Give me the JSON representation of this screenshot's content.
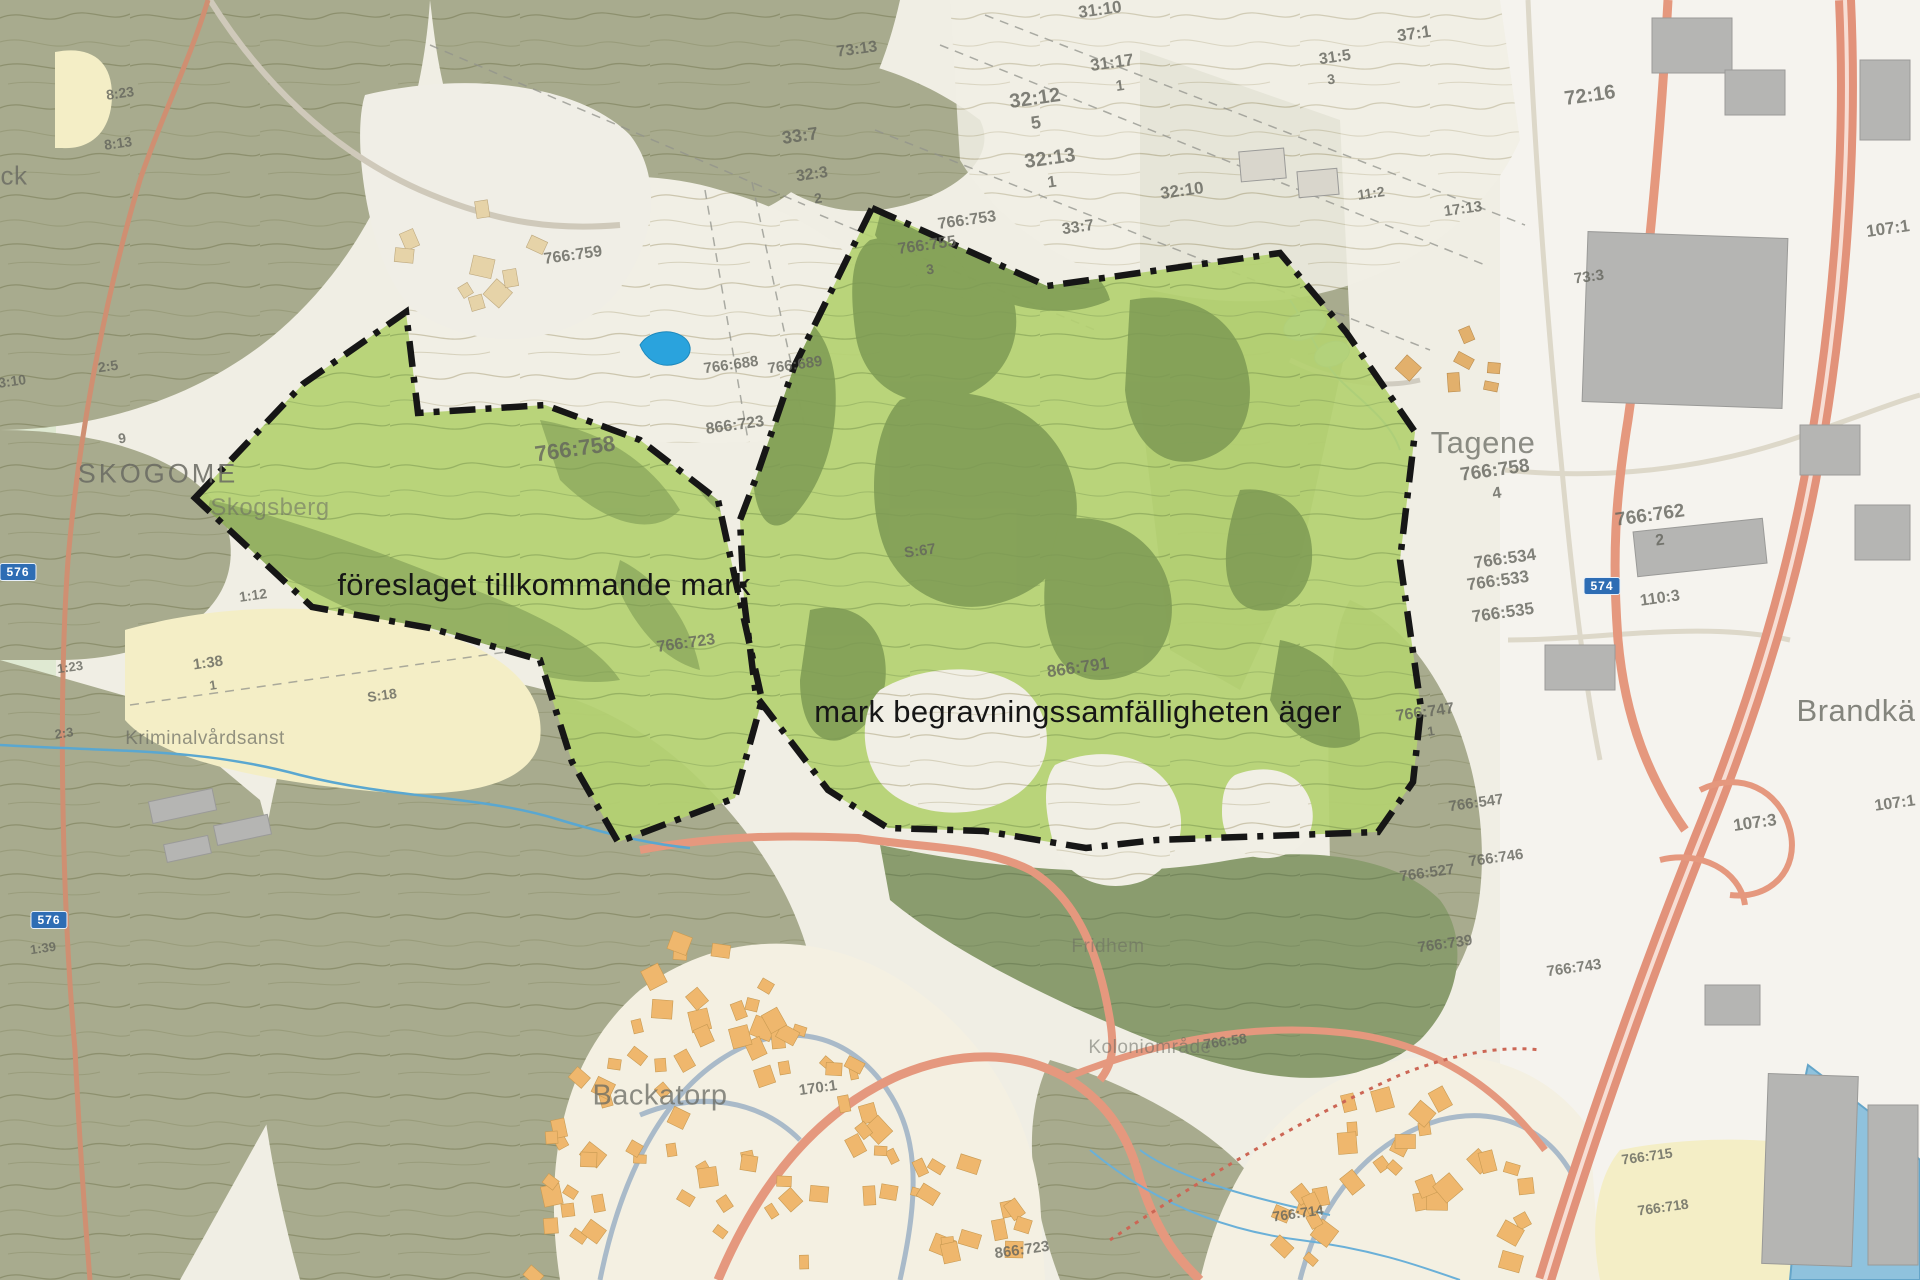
{
  "map": {
    "description": "Swedish cadastral / topographic map with two outlined cemetery land areas",
    "colors": {
      "highlight_green": "#b4d171",
      "dark_patch_green": "#7d9a54",
      "forest_olive": "#a8ab8e",
      "dark_forest": "#8a9c6e",
      "pale_green": "#dfe9d2",
      "field_yellow": "#f4eec6",
      "residential_orange": "#efb76d",
      "road_salmon": "#e5987e",
      "water_blue": "#2aa3dd",
      "river_blue": "#8fc2dd",
      "boundary_black": "#161616",
      "label_gray": "#696a62"
    },
    "main_labels": [
      {
        "id": "proposed",
        "text": "föreslaget tillkommande mark",
        "x": 544,
        "y": 585
      },
      {
        "id": "owned",
        "text": "mark begravningssamfälligheten äger",
        "x": 1078,
        "y": 712
      }
    ],
    "place_names": [
      {
        "text": "SKOGOME",
        "x": 158,
        "y": 474,
        "size": 27,
        "spacing": 3,
        "op": 0.85
      },
      {
        "text": "Skogsberg",
        "x": 270,
        "y": 508,
        "size": 24,
        "op": 0.55
      },
      {
        "text": "Tagene",
        "x": 1483,
        "y": 443,
        "size": 31,
        "op": 0.75
      },
      {
        "text": "Brandkä",
        "x": 1856,
        "y": 711,
        "size": 31,
        "op": 0.8
      },
      {
        "text": "Backatorp",
        "x": 660,
        "y": 1096,
        "size": 29,
        "op": 0.75
      },
      {
        "text": "Fridhem",
        "x": 1108,
        "y": 947,
        "size": 19,
        "op": 0.5
      },
      {
        "text": "Koloniområde",
        "x": 1150,
        "y": 1048,
        "size": 19,
        "op": 0.55
      },
      {
        "text": "Kriminalvårdsanst",
        "x": 205,
        "y": 739,
        "size": 19,
        "op": 0.7
      },
      {
        "text": "ck",
        "x": 14,
        "y": 176,
        "size": 26,
        "op": 0.8
      }
    ],
    "parcels": [
      {
        "text": "31:10",
        "x": 1100,
        "y": 10,
        "size": 17
      },
      {
        "text": "31:17",
        "x": 1112,
        "y": 63,
        "size": 17
      },
      {
        "text": "1",
        "x": 1120,
        "y": 86,
        "size": 15
      },
      {
        "text": "32:12",
        "x": 1035,
        "y": 99,
        "size": 20
      },
      {
        "text": "5",
        "x": 1036,
        "y": 123,
        "size": 18
      },
      {
        "text": "32:13",
        "x": 1050,
        "y": 159,
        "size": 20
      },
      {
        "text": "1",
        "x": 1052,
        "y": 183,
        "size": 16
      },
      {
        "text": "33:7",
        "x": 800,
        "y": 136,
        "size": 18
      },
      {
        "text": "73:13",
        "x": 857,
        "y": 50,
        "size": 16
      },
      {
        "text": "32:3",
        "x": 812,
        "y": 175,
        "size": 16
      },
      {
        "text": "2",
        "x": 818,
        "y": 198,
        "size": 14
      },
      {
        "text": "37:1",
        "x": 1414,
        "y": 34,
        "size": 17
      },
      {
        "text": "31:5",
        "x": 1335,
        "y": 58,
        "size": 16
      },
      {
        "text": "3",
        "x": 1331,
        "y": 79,
        "size": 14
      },
      {
        "text": "32:10",
        "x": 1182,
        "y": 191,
        "size": 17
      },
      {
        "text": "33:7",
        "x": 1078,
        "y": 228,
        "size": 16
      },
      {
        "text": "766:753",
        "x": 967,
        "y": 221,
        "size": 16
      },
      {
        "text": "766:755",
        "x": 927,
        "y": 246,
        "size": 16
      },
      {
        "text": "3",
        "x": 930,
        "y": 269,
        "size": 14
      },
      {
        "text": "17:13",
        "x": 1463,
        "y": 209,
        "size": 15
      },
      {
        "text": "11:2",
        "x": 1371,
        "y": 193,
        "size": 14
      },
      {
        "text": "72:16",
        "x": 1590,
        "y": 96,
        "size": 20
      },
      {
        "text": "107:1",
        "x": 1888,
        "y": 229,
        "size": 17
      },
      {
        "text": "73:3",
        "x": 1589,
        "y": 277,
        "size": 15
      },
      {
        "text": "766:759",
        "x": 573,
        "y": 256,
        "size": 16
      },
      {
        "text": "766:758",
        "x": 575,
        "y": 449,
        "size": 22
      },
      {
        "text": "866:723",
        "x": 735,
        "y": 426,
        "size": 16
      },
      {
        "text": "766:688",
        "x": 731,
        "y": 365,
        "size": 15
      },
      {
        "text": "766:689",
        "x": 795,
        "y": 365,
        "size": 15
      },
      {
        "text": "766:723",
        "x": 686,
        "y": 644,
        "size": 16
      },
      {
        "text": "S:67",
        "x": 920,
        "y": 551,
        "size": 15
      },
      {
        "text": "866:791",
        "x": 1078,
        "y": 668,
        "size": 17
      },
      {
        "text": "766:747",
        "x": 1425,
        "y": 713,
        "size": 16
      },
      {
        "text": "1",
        "x": 1431,
        "y": 731,
        "size": 13
      },
      {
        "text": "766:758",
        "x": 1495,
        "y": 471,
        "size": 19
      },
      {
        "text": "4",
        "x": 1497,
        "y": 494,
        "size": 16
      },
      {
        "text": "766:762",
        "x": 1650,
        "y": 516,
        "size": 19
      },
      {
        "text": "2",
        "x": 1660,
        "y": 541,
        "size": 16
      },
      {
        "text": "766:534",
        "x": 1505,
        "y": 559,
        "size": 17
      },
      {
        "text": "766:533",
        "x": 1498,
        "y": 581,
        "size": 17
      },
      {
        "text": "766:535",
        "x": 1503,
        "y": 613,
        "size": 17
      },
      {
        "text": "110:3",
        "x": 1660,
        "y": 599,
        "size": 16
      },
      {
        "text": "766:547",
        "x": 1476,
        "y": 803,
        "size": 15
      },
      {
        "text": "766:746",
        "x": 1496,
        "y": 858,
        "size": 15
      },
      {
        "text": "766:527",
        "x": 1427,
        "y": 873,
        "size": 15
      },
      {
        "text": "766:739",
        "x": 1445,
        "y": 944,
        "size": 15
      },
      {
        "text": "766:743",
        "x": 1574,
        "y": 968,
        "size": 15
      },
      {
        "text": "107:3",
        "x": 1755,
        "y": 823,
        "size": 17
      },
      {
        "text": "107:1",
        "x": 1895,
        "y": 804,
        "size": 16
      },
      {
        "text": "766:58",
        "x": 1225,
        "y": 1041,
        "size": 14
      },
      {
        "text": "170:1",
        "x": 818,
        "y": 1088,
        "size": 15
      },
      {
        "text": "866:723",
        "x": 1022,
        "y": 1250,
        "size": 15
      },
      {
        "text": "766:714",
        "x": 1298,
        "y": 1213,
        "size": 14
      },
      {
        "text": "766:715",
        "x": 1647,
        "y": 1156,
        "size": 14
      },
      {
        "text": "766:718",
        "x": 1663,
        "y": 1207,
        "size": 14
      },
      {
        "text": "8:23",
        "x": 120,
        "y": 93,
        "size": 14
      },
      {
        "text": "8:13",
        "x": 118,
        "y": 143,
        "size": 14
      },
      {
        "text": "2:5",
        "x": 108,
        "y": 366,
        "size": 14
      },
      {
        "text": "3:10",
        "x": 12,
        "y": 381,
        "size": 14
      },
      {
        "text": "9",
        "x": 122,
        "y": 438,
        "size": 14
      },
      {
        "text": "1:12",
        "x": 253,
        "y": 595,
        "size": 14
      },
      {
        "text": "1:38",
        "x": 208,
        "y": 663,
        "size": 15
      },
      {
        "text": "1",
        "x": 213,
        "y": 685,
        "size": 13
      },
      {
        "text": "1:23",
        "x": 70,
        "y": 667,
        "size": 13
      },
      {
        "text": "S:18",
        "x": 382,
        "y": 695,
        "size": 14
      },
      {
        "text": "2:3",
        "x": 64,
        "y": 733,
        "size": 13
      },
      {
        "text": "1:39",
        "x": 43,
        "y": 948,
        "size": 13
      }
    ],
    "road_shields": [
      {
        "text": "574",
        "x": 1602,
        "y": 586
      },
      {
        "text": "576",
        "x": 18,
        "y": 572
      },
      {
        "text": "576",
        "x": 49,
        "y": 920
      }
    ]
  }
}
